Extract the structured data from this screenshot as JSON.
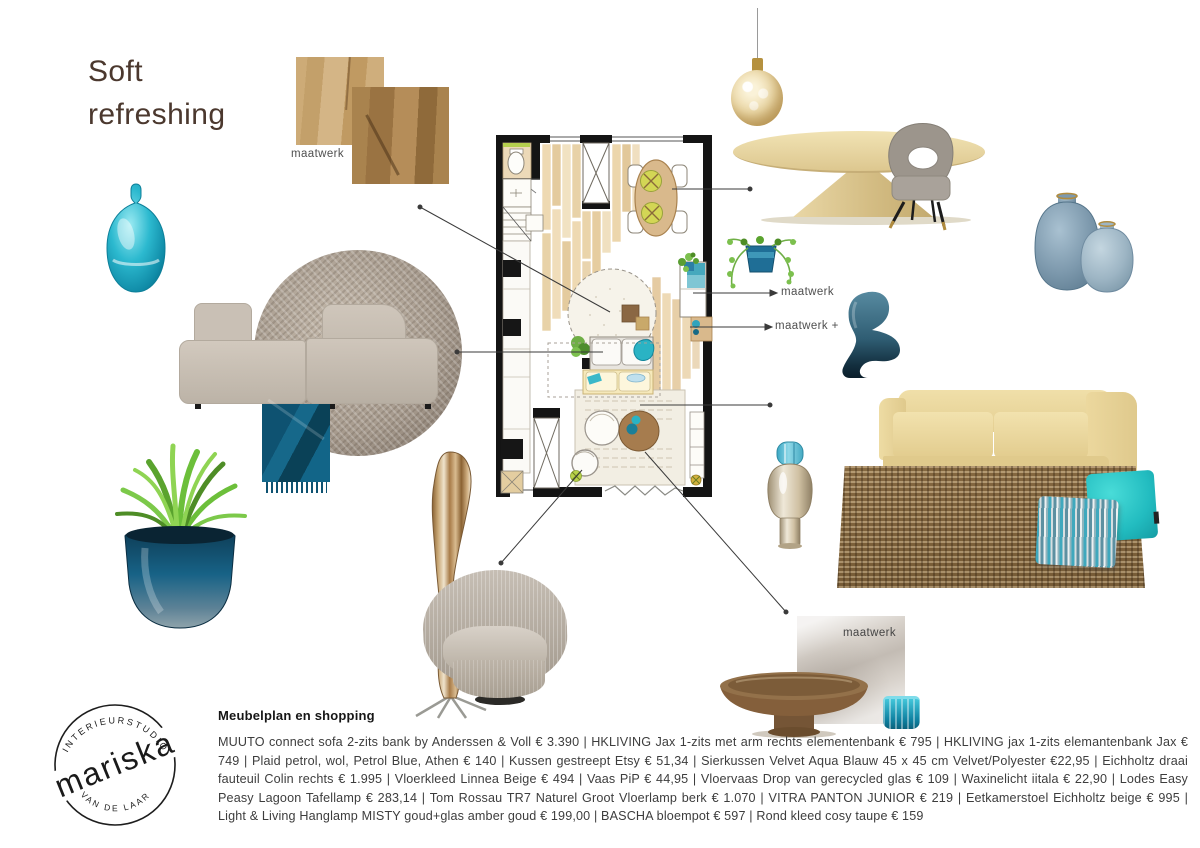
{
  "title": {
    "line1": "Soft",
    "line2": "refreshing"
  },
  "annotations": {
    "wood_sample": "maatwerk",
    "cabinet": "maatwerk",
    "cabinet_plus": "maatwerk +",
    "stone_sample": "maatwerk"
  },
  "logo": {
    "arc_top": "INTERIEURSTUDIO",
    "name": "mariska",
    "arc_bottom": "VAN DE LAAR"
  },
  "shopping_list": {
    "heading": "Meubelplan en shopping",
    "separator": " | ",
    "items": [
      "MUUTO connect sofa 2-zits bank by Anderssen & Voll € 3.390",
      "HKLIVING Jax 1-zits met arm rechts elementenbank € 795",
      "HKLIVING jax 1-zits elemantenbank Jax € 749",
      "Plaid petrol, wol, Petrol Blue, Athen € 140",
      "Kussen gestreept Etsy € 51,34",
      "Sierkussen Velvet Aqua Blauw 45 x 45 cm Velvet/Polyester €22,95",
      "Eichholtz draai fauteuil Colin rechts € 1.995",
      "Vloerkleed Linnea Beige € 494",
      "Vaas PiP € 44,95",
      "Vloervaas Drop van gerecycled glas € 109",
      "Waxinelicht iitala € 22,90",
      "Lodes Easy Peasy Lagoon Tafellamp € 283,14",
      "Tom Rossau TR7 Naturel Groot Vloerlamp berk € 1.070",
      "VITRA PANTON JUNIOR € 219",
      "Eetkamerstoel Eichholtz beige € 995",
      "Light & Living Hanglamp MISTY goud+glas amber goud € 199,00",
      "BASCHA bloempot € 597",
      "Rond kleed cosy taupe € 159"
    ]
  },
  "palette": {
    "accent_teal": "#2ab7cc",
    "petrol_blue": "#10627f",
    "soft_yellow": "#ecd9a2",
    "title_brown": "#4b382e",
    "taupe": "#a79b8e"
  }
}
